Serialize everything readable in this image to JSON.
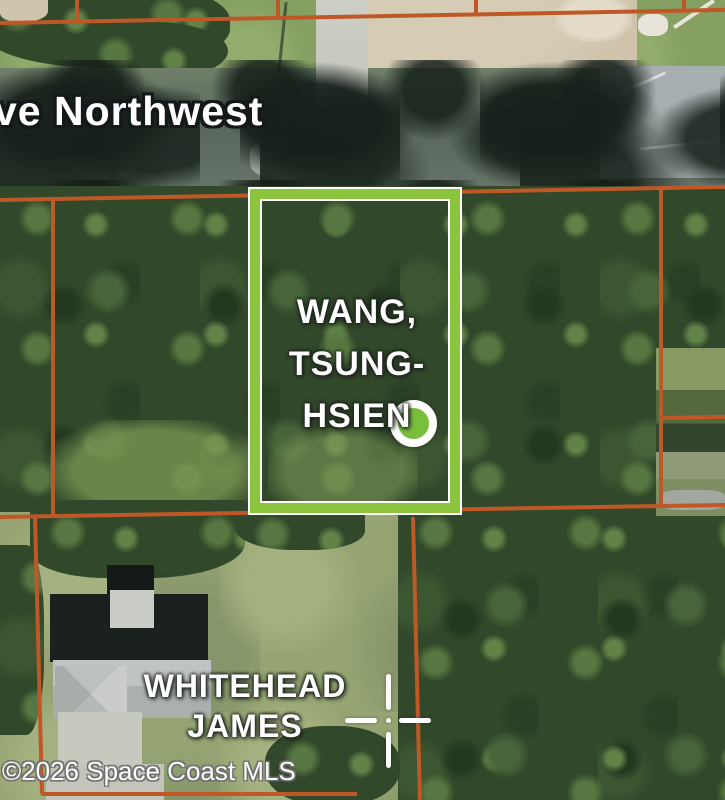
{
  "map": {
    "type": "aerial-parcel-map",
    "street_label": "ve Northwest",
    "copyright": "©2026 Space Coast MLS",
    "selected_parcel": {
      "owner": "WANG, TSUNG-HSIEN",
      "owner_lines": [
        "WANG,",
        "TSUNG-",
        "HSIEN"
      ],
      "outline_color": "#8cc63f",
      "marker": "green-dot"
    },
    "adjacent_parcel": {
      "owner": "WHITEHEAD JAMES",
      "owner_lines": [
        "WHITEHEAD",
        "JAMES"
      ],
      "marker": "survey-crosshair"
    },
    "overlay_colors": {
      "parcel_boundary": "#bf5827",
      "selected_outline_green": "#8cc63f",
      "selected_outline_trim": "#ffffff",
      "marker_fill": "#7cc140",
      "label_text": "#ffffff"
    }
  }
}
